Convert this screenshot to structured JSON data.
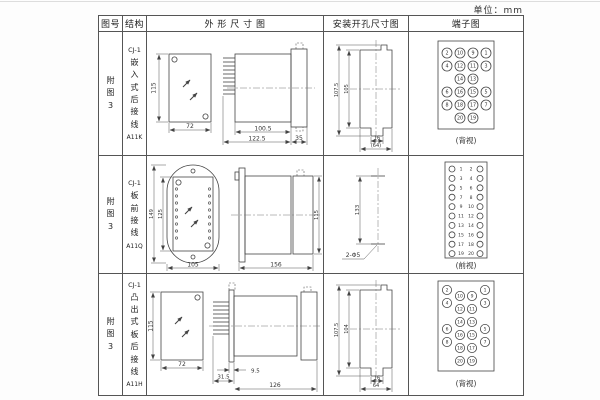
{
  "page": {
    "unit_label": "单位：mm"
  },
  "colors": {
    "line": "#444444",
    "border": "#555555"
  },
  "table": {
    "headers": {
      "fig_no": "图号",
      "structure": "结构",
      "outline": "外 形 尺 寸 图",
      "install": "安装开孔尺寸图",
      "terminal": "端子图"
    },
    "rows": [
      {
        "fig_no": "附图3",
        "model": "CJ-1",
        "structure_desc": "嵌入式后接线",
        "code": "A11K",
        "outline": {
          "h": "115",
          "w": "72",
          "l1": "100.5",
          "l2": "122.5",
          "l3": "35"
        },
        "install": {
          "v1": "107.5",
          "v2": "105",
          "w1": "16",
          "w2": "(64)"
        },
        "terminal": {
          "view_label": "(背视)",
          "t": [
            "2",
            "10",
            "9",
            "1",
            "4",
            "12",
            "11",
            "3",
            "14",
            "13",
            "6",
            "16",
            "15",
            "5",
            "8",
            "18",
            "17",
            "7",
            "20",
            "19"
          ]
        }
      },
      {
        "fig_no": "附图3",
        "model": "CJ-1",
        "structure_desc": "板前接线",
        "code": "A11Q",
        "outline": {
          "h1": "149",
          "h2": "125",
          "w": "105",
          "l": "156",
          "bh": "115"
        },
        "install": {
          "spacing": "133",
          "hole": "2-Φ5"
        },
        "terminal": {
          "view_label": "(前视)",
          "left": [
            "1",
            "3",
            "5",
            "7",
            "9",
            "11",
            "13",
            "15",
            "17",
            "19"
          ],
          "right": [
            "2",
            "4",
            "6",
            "8",
            "10",
            "12",
            "14",
            "16",
            "18",
            "20"
          ]
        }
      },
      {
        "fig_no": "附图3",
        "model": "CJ-1",
        "structure_desc": "凸出式板后接线",
        "code": "A11H",
        "outline": {
          "h": "115",
          "w": "72",
          "p": "31.5",
          "f": "9.5",
          "l": "126"
        },
        "install": {
          "v1": "107.5",
          "v2": "104",
          "w1": "16",
          "w2": "64"
        },
        "terminal": {
          "view_label": "(背视)",
          "t": [
            "2",
            "1",
            "10",
            "9",
            "4",
            "3",
            "12",
            "11",
            "14",
            "13",
            "6",
            "5",
            "16",
            "15",
            "8",
            "7",
            "18",
            "17",
            "20",
            "19"
          ]
        }
      }
    ]
  }
}
